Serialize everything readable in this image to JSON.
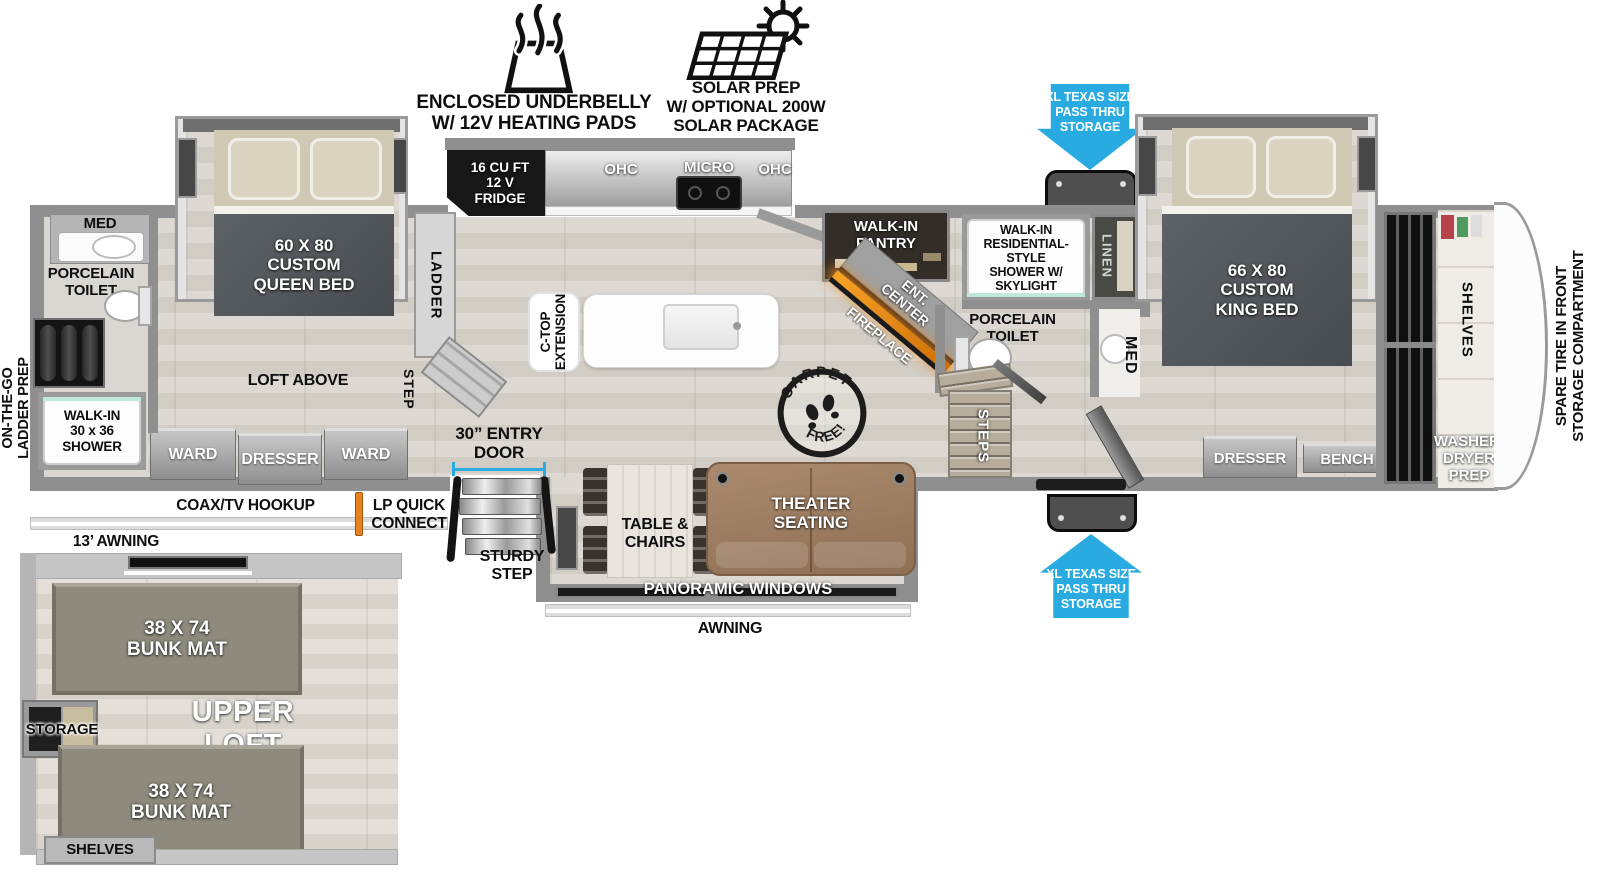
{
  "icons": {
    "heat": "underbelly-heat-icon",
    "solar": "solar-panel-sun-icon",
    "pass_thru_top": "arrow-down-icon",
    "pass_thru_bottom": "arrow-up-icon",
    "stamp": "carpet-free-stamp-icon"
  },
  "callouts": {
    "underbelly": "ENCLOSED UNDERBELLY\nW/ 12V HEATING PADS",
    "solar": "SOLAR PREP\nW/ OPTIONAL 200W\nSOLAR PACKAGE",
    "pass_thru_top": "XL TEXAS SIZE\nPASS THRU\nSTORAGE",
    "pass_thru_bottom": "XL TEXAS SIZE\nPASS THRU\nSTORAGE",
    "carpet": "CARPET",
    "free": "FREE!"
  },
  "exterior": {
    "ladder_prep": "ON-THE-GO\nLADDER PREP",
    "coax": "COAX/TV HOOKUP",
    "lp_quick": "LP QUICK\nCONNECT",
    "awning_13": "13’ AWNING",
    "awning": "AWNING",
    "spare_tire": "SPARE TIRE IN FRONT\nSTORAGE COMPARTMENT"
  },
  "bedroom_rear": {
    "bed": "60 X  80\nCUSTOM\nQUEEN BED",
    "loft_above": "LOFT ABOVE",
    "ward_left": "WARD",
    "dresser": "DRESSER",
    "ward_right": "WARD",
    "ladder": "LADDER",
    "step": "STEP"
  },
  "bath_rear": {
    "med": "MED",
    "toilet": "PORCELAIN\nTOILET",
    "shower": "WALK-IN\n30 x 36\nSHOWER"
  },
  "kitchen": {
    "fridge": "16 CU FT\n12 V\nFRIDGE",
    "ohc_left": "OHC",
    "micro": "MICRO",
    "ohc_right": "OHC",
    "ctop": "C-TOP\nEXTENSION",
    "pantry": "WALK-IN\nPANTRY",
    "ent_center": "ENT.\nCENTER",
    "fireplace": "FIREPLACE"
  },
  "living": {
    "entry_door": "30” ENTRY\nDOOR",
    "sturdy_step": "STURDY\nSTEP",
    "table_chairs": "TABLE &\nCHAIRS",
    "theater": "THEATER\nSEATING",
    "panoramic": "PANORAMIC WINDOWS"
  },
  "bath_main": {
    "shower": "WALK-IN\nRESIDENTIAL-STYLE\nSHOWER W/\nSKYLIGHT",
    "linen": "LINEN",
    "toilet": "PORCELAIN\nTOILET",
    "med": "MED",
    "steps": "STEPS"
  },
  "bedroom_front": {
    "bed": "66 X  80\nCUSTOM\nKING BED",
    "dresser": "DRESSER",
    "bench": "BENCH",
    "shelves": "SHELVES",
    "washer_dryer": "WASHER/\nDRYER\nPREP"
  },
  "loft": {
    "bunk_top": "38 X 74\nBUNK MAT",
    "upper_loft": "UPPER\nLOFT",
    "storage": "STORAGE",
    "bunk_bottom": "38 X 74\nBUNK MAT",
    "shelves": "SHELVES"
  },
  "colors": {
    "arrow_blue": "#29abe2",
    "lp_orange": "#e8821e",
    "fire_orange": "#f08a1d",
    "bed_gray": "#54585a",
    "sofa_brown": "#a5846b",
    "bunk_olive": "#8d887c"
  }
}
